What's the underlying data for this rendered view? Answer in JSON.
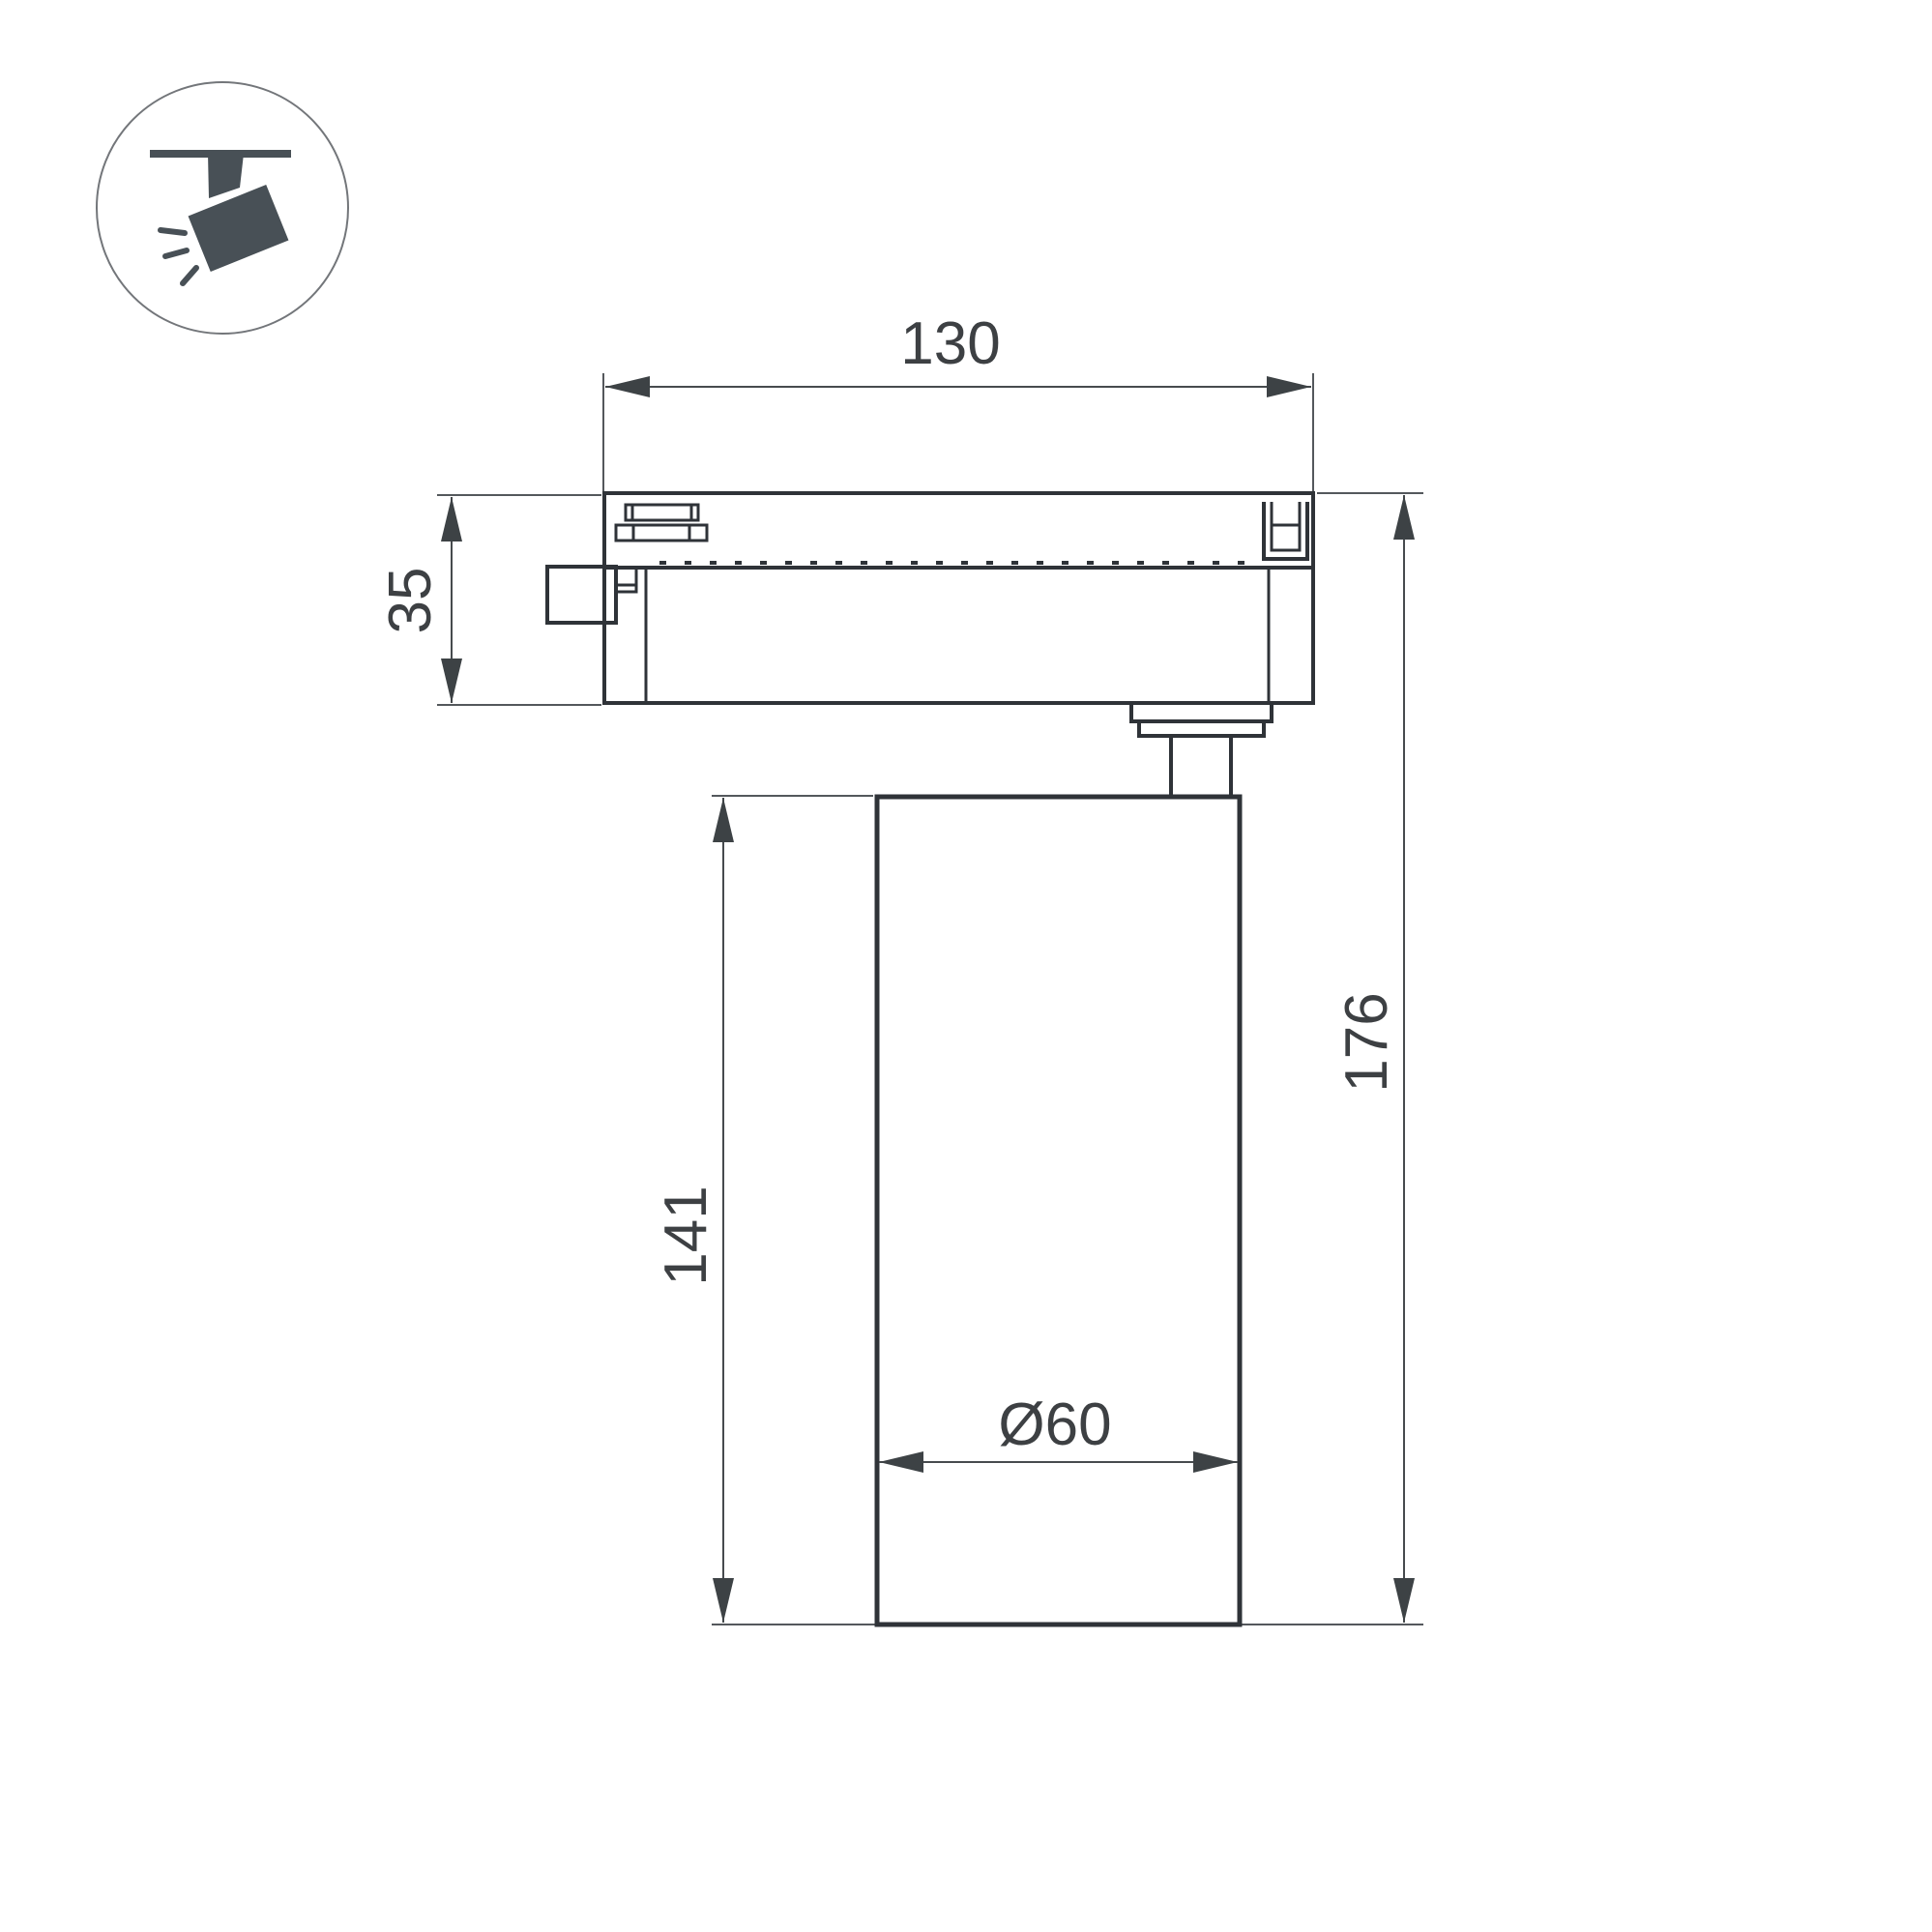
{
  "drawing": {
    "labels": {
      "track_width": "130",
      "adapter_height": "35",
      "overall_height": "176",
      "body_height": "141",
      "body_diameter": "Ø60"
    },
    "icon": "ceiling-track-spotlight",
    "colors": {
      "outline": "#2f3338",
      "dimension_line": "#54585c",
      "dimension_text": "#3d4043",
      "icon_glyph": "#485056",
      "icon_circle_stroke": "#73767a",
      "background": "#ffffff"
    }
  }
}
